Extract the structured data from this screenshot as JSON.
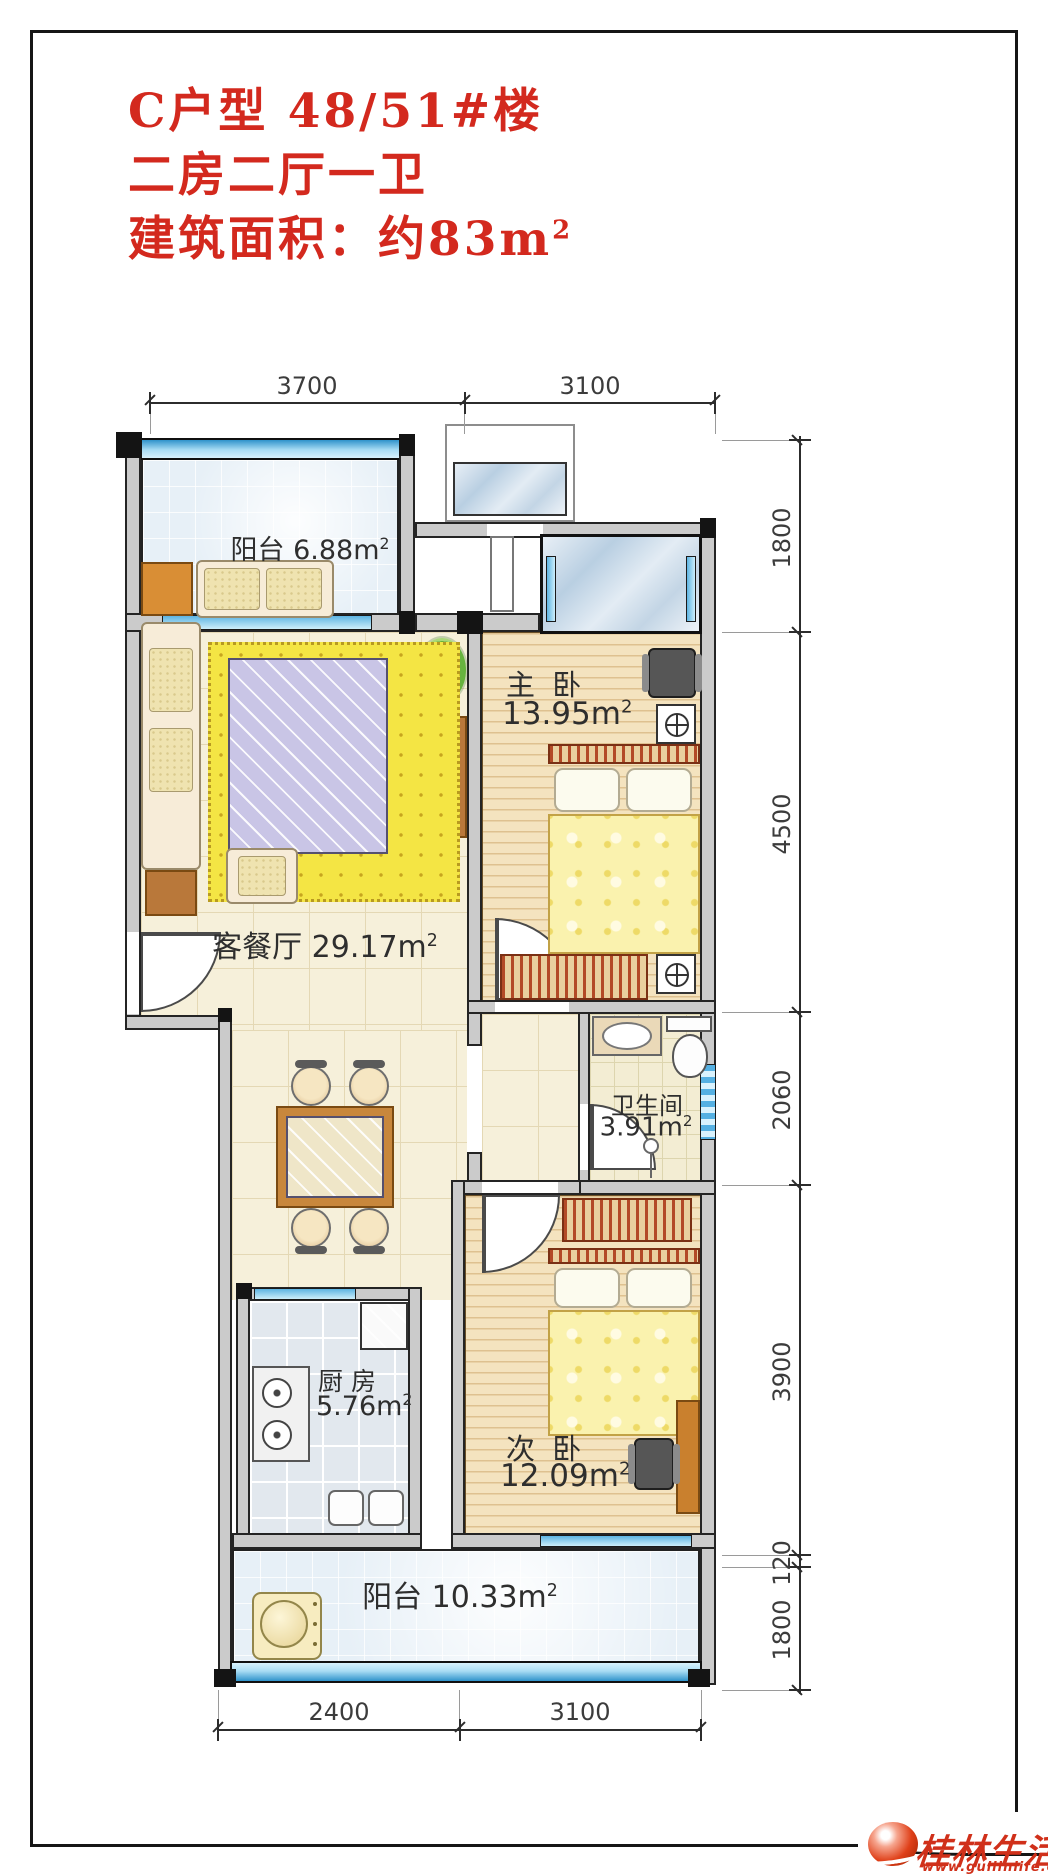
{
  "title": {
    "line1": "C户型 48/51#楼",
    "line2": "二房二厅一卫",
    "line3": "建筑面积：约83m",
    "line3_sup": "2"
  },
  "dims": {
    "top": [
      "3700",
      "3100"
    ],
    "bottom": [
      "2400",
      "3100"
    ],
    "right": [
      "1800",
      "4500",
      "2060",
      "3900",
      "120",
      "1800"
    ]
  },
  "rooms": {
    "balcony_top": {
      "name": "阳台",
      "area": "6.88m",
      "sup": "2"
    },
    "master_bedroom": {
      "name": "主 卧",
      "area": "13.95m",
      "sup": "2"
    },
    "living_dining": {
      "name": "客餐厅",
      "area": "29.17m",
      "sup": "2"
    },
    "bathroom": {
      "name": "卫生间",
      "area": "3.91m",
      "sup": "2"
    },
    "kitchen": {
      "name": "厨 房",
      "area": "5.76m",
      "sup": "2"
    },
    "second_bedroom": {
      "name": "次 卧",
      "area": "12.09m",
      "sup": "2"
    },
    "balcony_bottom": {
      "name": "阳台",
      "area": "10.33m",
      "sup": "2"
    }
  },
  "watermark": {
    "site_name": "桂林生活网",
    "site_url": "www.guilinlife.com"
  },
  "colors": {
    "title_red": "#d3291e",
    "watermark_red": "#d0301a",
    "window_blue": "#5db4e2",
    "wall_gray": "#cbcbcb",
    "wood_floor": "#f4e3bf",
    "tile_cream": "#f6f0da",
    "balcony_blue": "#e7f0f7",
    "rug_yellow": "#f4e544"
  }
}
